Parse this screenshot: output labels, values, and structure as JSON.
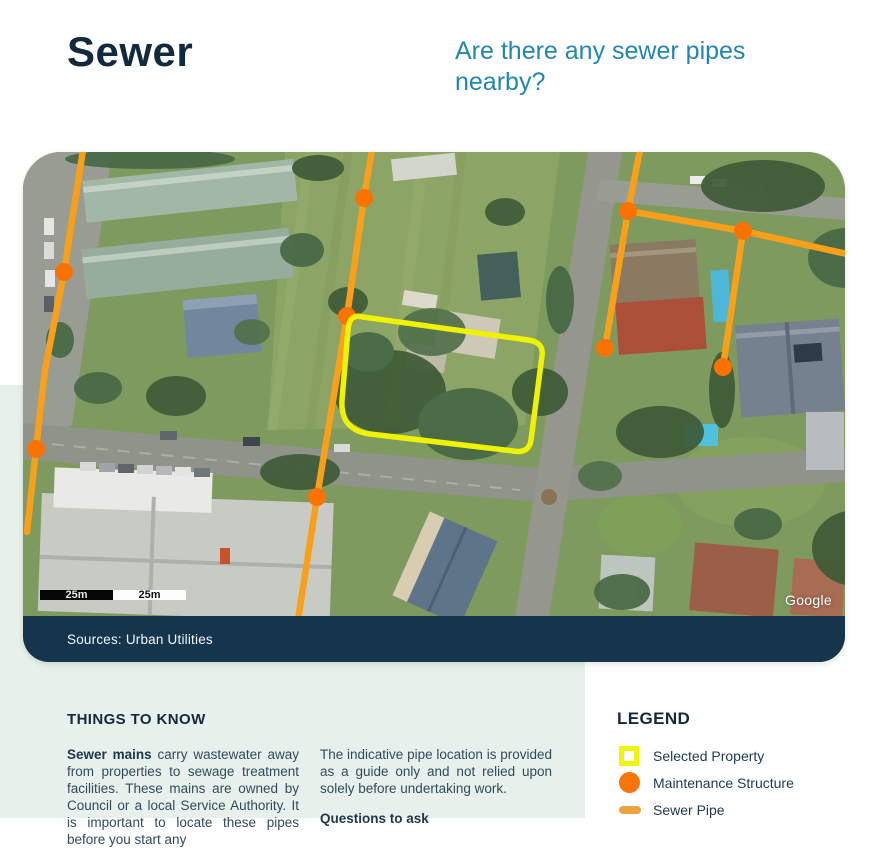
{
  "page": {
    "title": "Sewer",
    "question": "Are there any sewer pipes nearby?"
  },
  "map": {
    "sources": "Sources: Urban Utilities",
    "google_label": "Google",
    "scale_left": "25m",
    "scale_right": "25m"
  },
  "things_to_know": {
    "heading": "THINGS TO KNOW",
    "col1_bold": "Sewer mains",
    "col1_rest": " carry wastewater away from properties to sewage treatment facilities. These mains are owned by Council or a local Service Authority. It is important to locate these pipes before you start any",
    "col2_paragraph": "The indicative pipe location is provided as a guide only and not relied upon solely before undertaking work.",
    "col2_heading": "Questions to ask"
  },
  "legend": {
    "heading": "LEGEND",
    "items": [
      {
        "label": "Selected Property",
        "icon": "selected-property-icon"
      },
      {
        "label": "Maintenance Structure",
        "icon": "maintenance-structure-icon"
      },
      {
        "label": "Sewer Pipe",
        "icon": "sewer-pipe-icon"
      }
    ]
  },
  "colors": {
    "heading_navy": "#13293D",
    "question_teal": "#2187B2",
    "mint_panel": "#E7F0EA",
    "sources_bar_navy": "#14354B",
    "pipe_orange": "#F9A01B",
    "maintenance_orange": "#F97304",
    "property_yellow": "#EFF303"
  }
}
